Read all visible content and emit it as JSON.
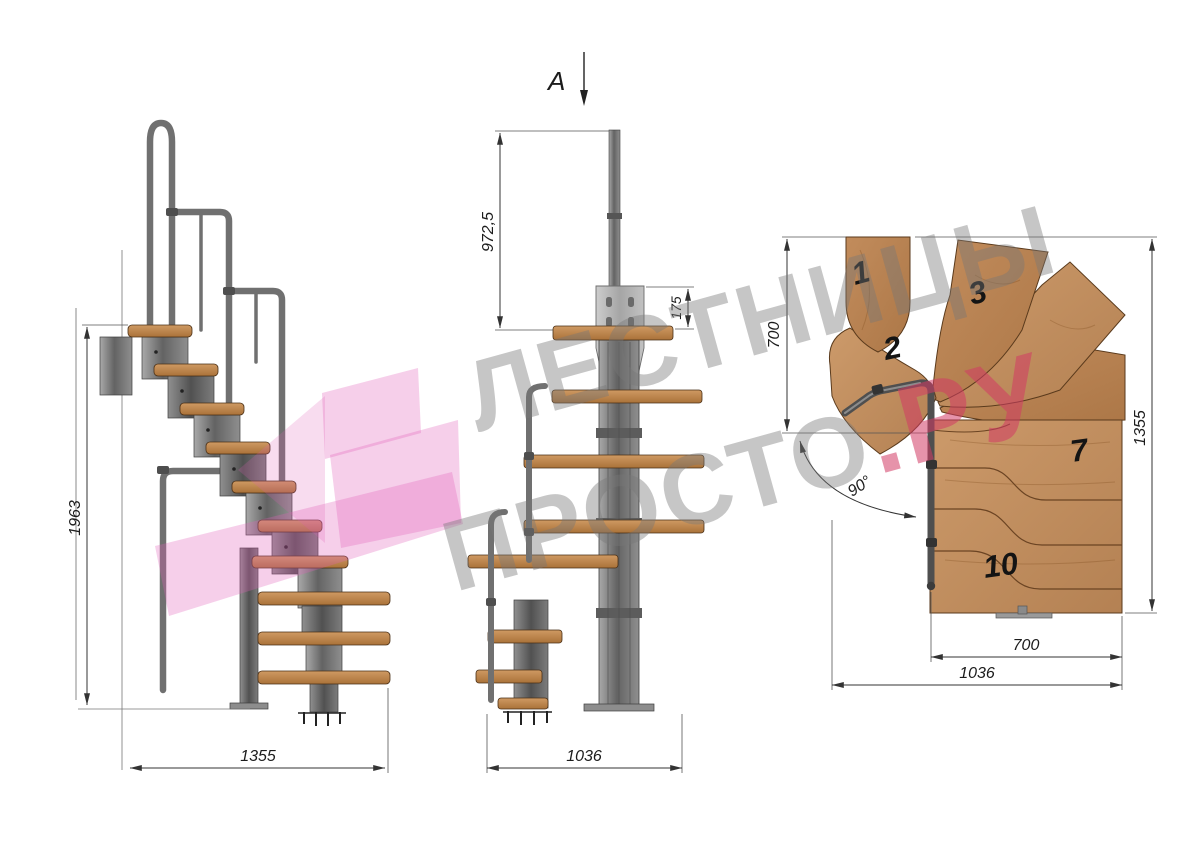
{
  "watermark": {
    "line1": "ЛЕСТНИЦЫ",
    "line2_gray": "ПРОСТО",
    "line2_pink": ".РУ"
  },
  "side": {
    "height": "1963",
    "width": "1355"
  },
  "front": {
    "marker": "A",
    "pole_height": "972,5",
    "plate_height": "175",
    "width": "1036"
  },
  "plan": {
    "left_depth": "700",
    "total_height": "1355",
    "tread_width": "700",
    "total_width": "1036",
    "angle": "90°",
    "treads": [
      "1",
      "2",
      "3",
      "7",
      "10"
    ]
  },
  "colors": {
    "wood": "#c59160",
    "wood_edge": "#5a3a1c",
    "metal": "#6f6f6f",
    "plate": "#bcbcbc",
    "dimension_line": "#333333",
    "watermark_gray": "#787878",
    "watermark_pink": "#d23b64",
    "logo_pink": "#e060b8"
  }
}
